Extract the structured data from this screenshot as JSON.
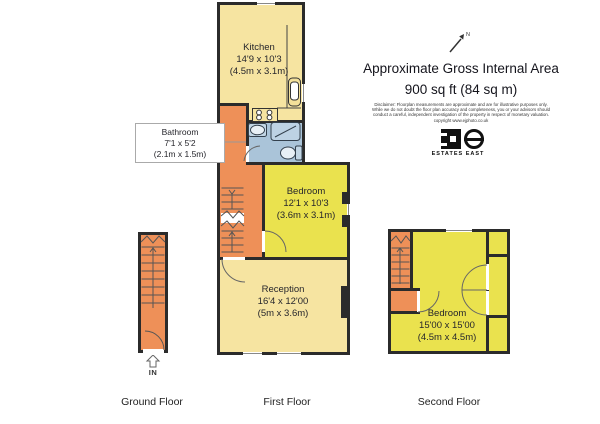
{
  "colors": {
    "wall": "#2b2b2b",
    "yellow": "#f6e4a1",
    "bright": "#eae24e",
    "orange": "#ee9058",
    "blue": "#aac4d9",
    "line": "#555555"
  },
  "header": {
    "title_line1": "Approximate Gross Internal Area",
    "title_line2": "900 sq ft (84 sq m)",
    "compass_label": "N"
  },
  "disclaimer": {
    "line1": "Disclaimer: Floorplan measurements are approximate and are for illustrative purposes only.",
    "line2": "While we do not doubt the floor plan accuracy and completeness, you or your advisors should",
    "line3": "conduct a careful, independent investigation of the property in respect of monetary valuation.",
    "line4": "copyright www.ejphoto.co.uk"
  },
  "branding": {
    "agency_name": "ESTATES EAST"
  },
  "floors": {
    "ground": {
      "label": "Ground Floor",
      "entrance_label": "IN"
    },
    "first": {
      "label": "First Floor"
    },
    "second": {
      "label": "Second Floor"
    }
  },
  "rooms": {
    "kitchen": {
      "name": "Kitchen",
      "size_imperial": "14'9 x 10'3",
      "size_metric": "(4.5m x 3.1m)"
    },
    "bathroom": {
      "name": "Bathroom",
      "size_imperial": "7'1 x 5'2",
      "size_metric": "(2.1m x 1.5m)"
    },
    "bedroom_first": {
      "name": "Bedroom",
      "size_imperial": "12'1 x 10'3",
      "size_metric": "(3.6m x 3.1m)"
    },
    "reception": {
      "name": "Reception",
      "size_imperial": "16'4 x 12'00",
      "size_metric": "(5m x 3.6m)"
    },
    "bedroom_second": {
      "name": "Bedroom",
      "size_imperial": "15'00 x 15'00",
      "size_metric": "(4.5m x 4.5m)"
    }
  }
}
